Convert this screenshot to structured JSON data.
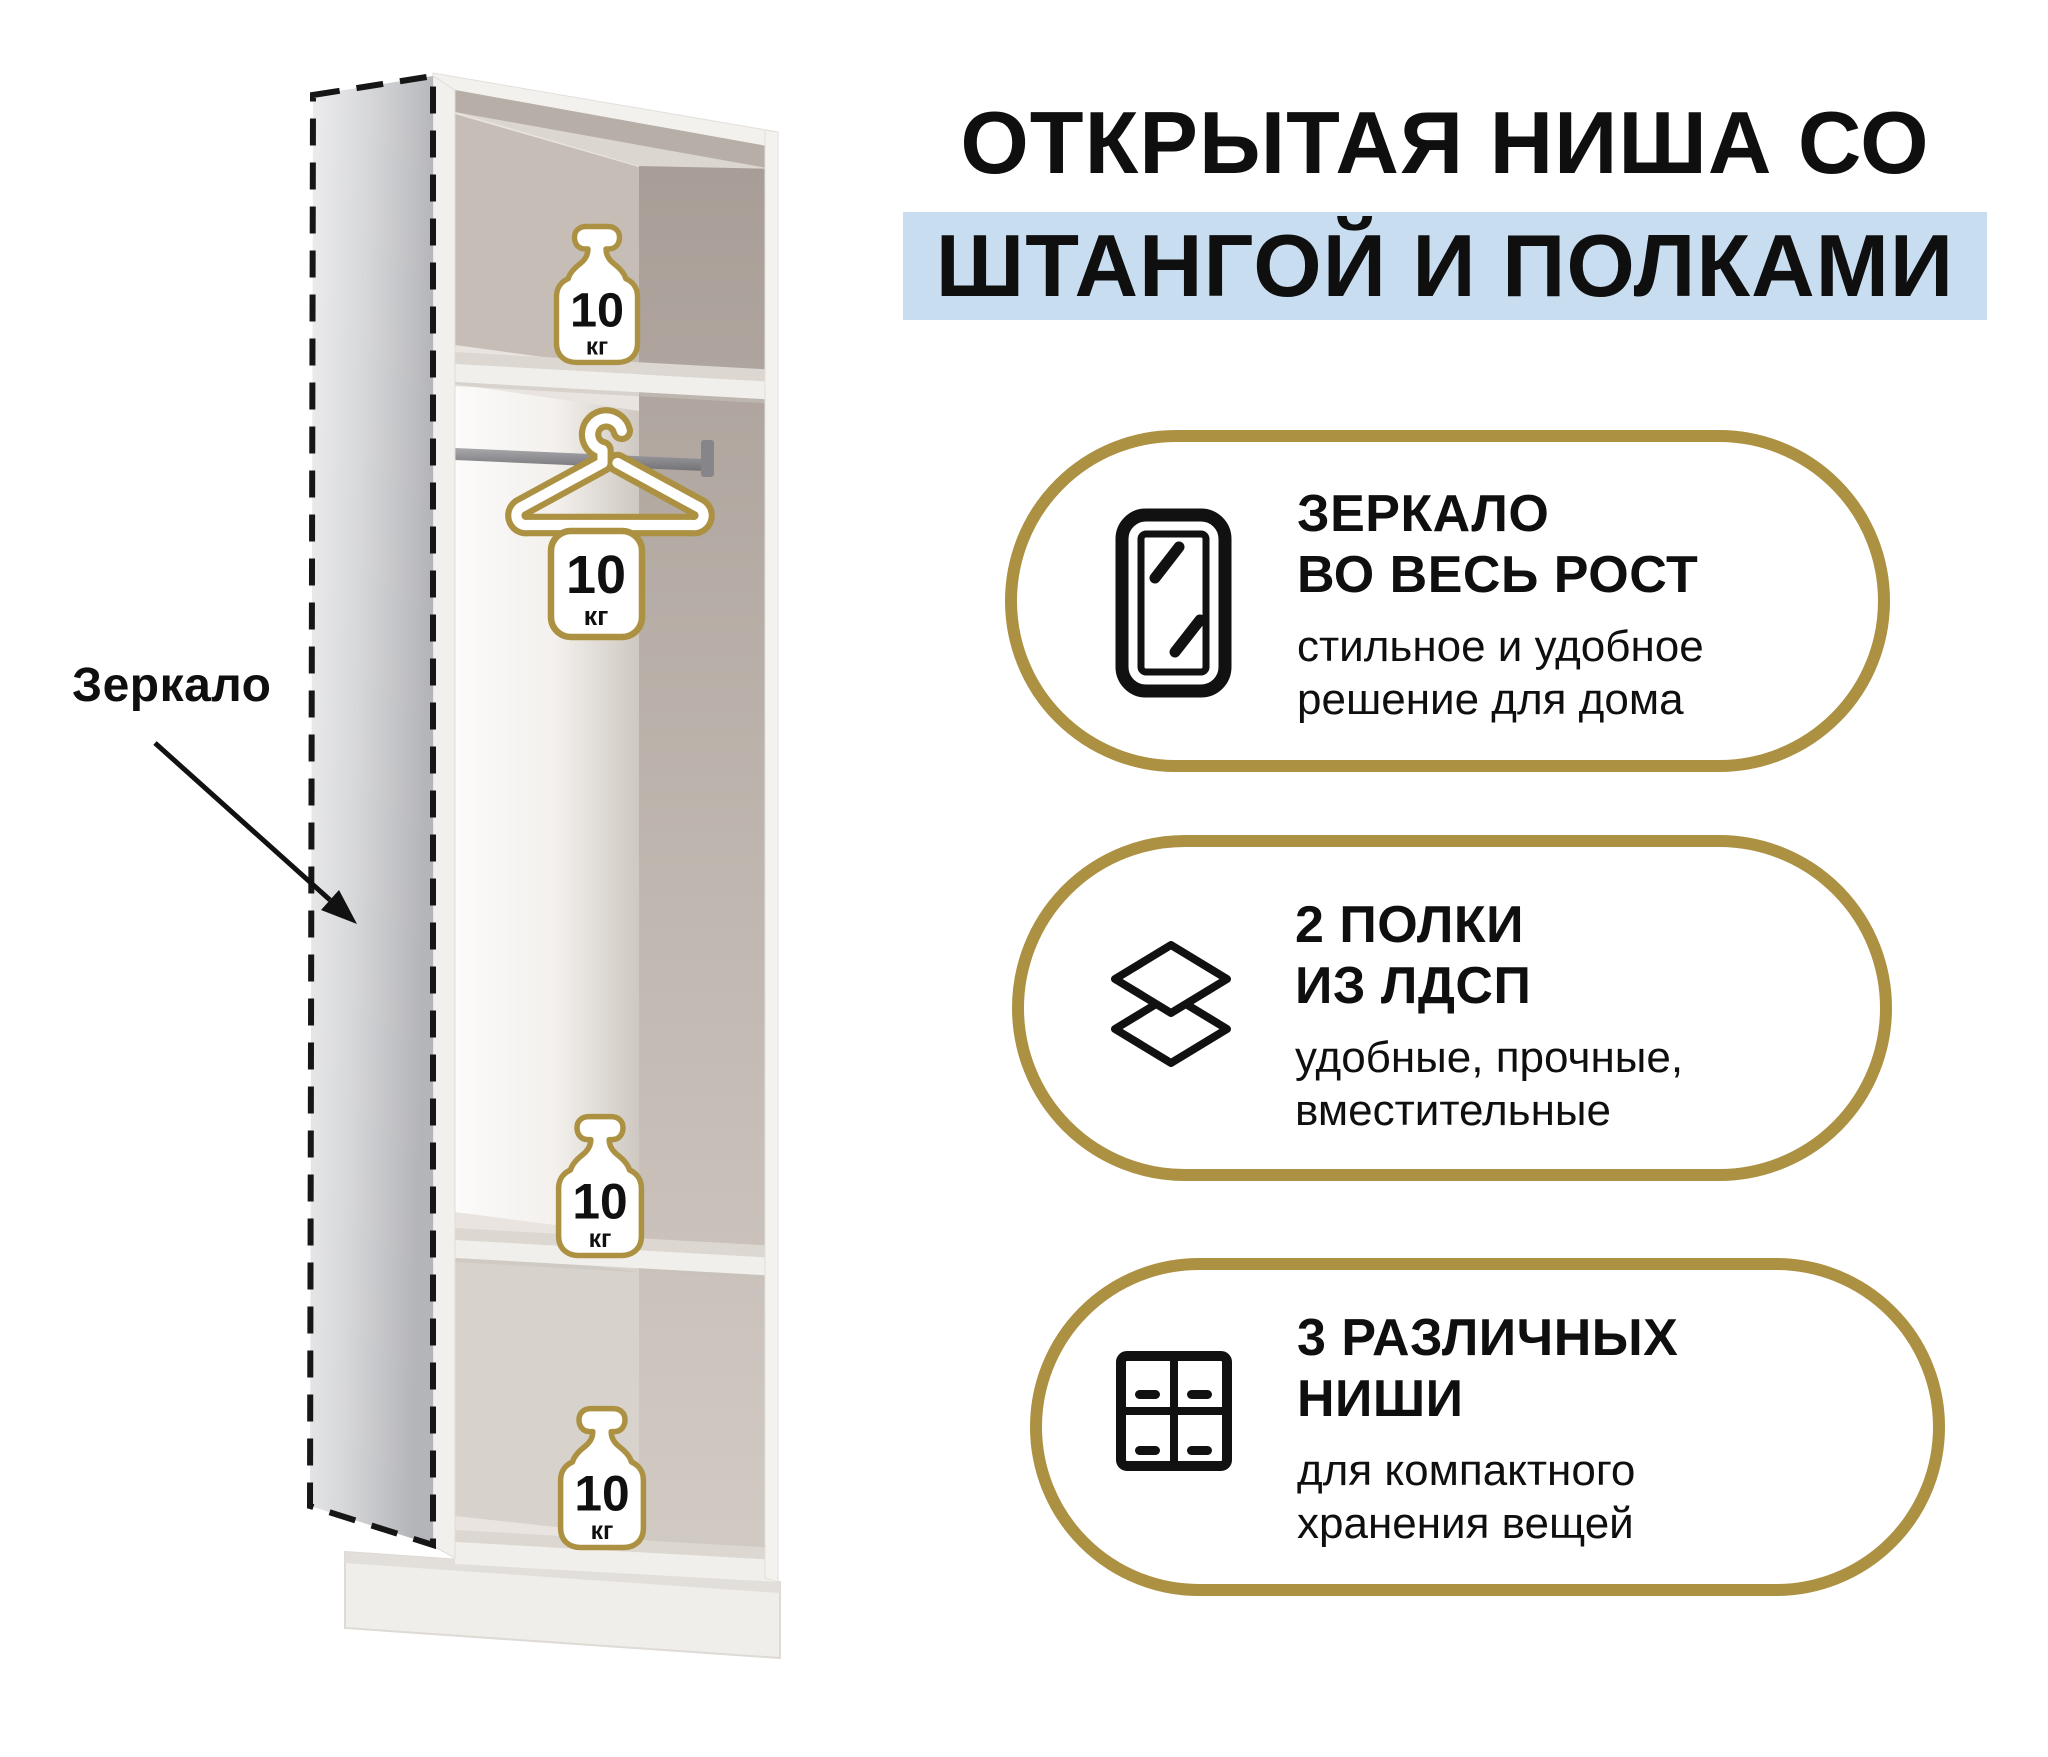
{
  "title": {
    "line1": "ОТКРЫТАЯ НИША СО",
    "line2": "ШТАНГОЙ И ПОЛКАМИ"
  },
  "annotation": {
    "mirror_label": "Зеркало"
  },
  "load_badge": {
    "value": "10",
    "unit": "кг"
  },
  "features": [
    {
      "icon": "mirror-icon",
      "heading_line1": "ЗЕРКАЛО",
      "heading_line2": "ВО ВЕСЬ РОСТ",
      "desc_line1": "стильное и удобное",
      "desc_line2": "решение для дома"
    },
    {
      "icon": "shelves-icon",
      "heading_line1": "2 ПОЛКИ",
      "heading_line2": "ИЗ ЛДСП",
      "desc_line1": "удобные, прочные,",
      "desc_line2": "вместительные"
    },
    {
      "icon": "niches-icon",
      "heading_line1": "3 РАЗЛИЧНЫХ",
      "heading_line2": "НИШИ",
      "desc_line1": "для компактного",
      "desc_line2": "хранения вещей"
    }
  ],
  "colors": {
    "gold": "#ac9142",
    "highlight_blue": "#c9ddf1",
    "ink": "#0f0f0f"
  }
}
